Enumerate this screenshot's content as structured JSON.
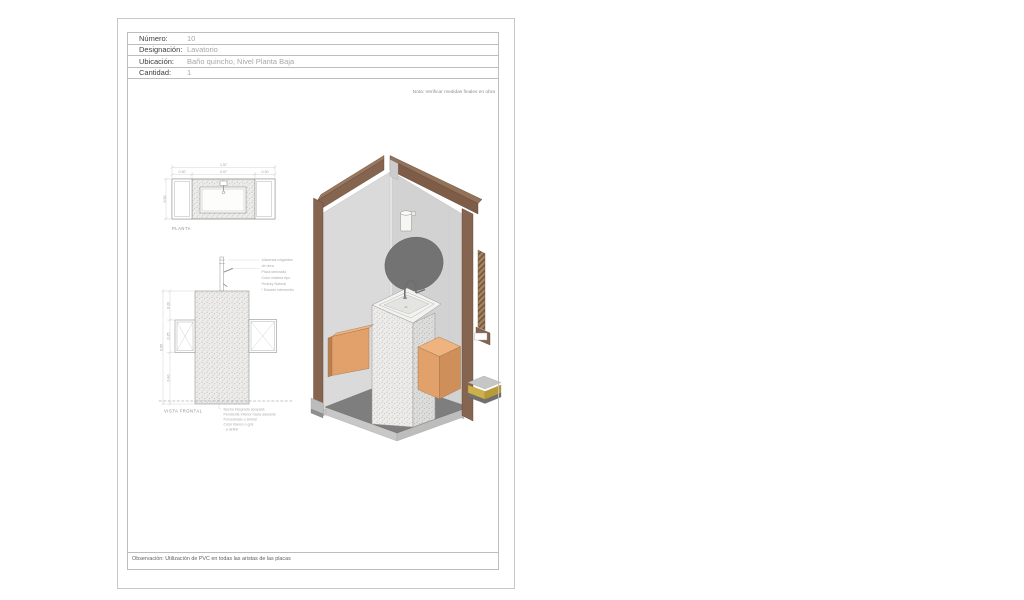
{
  "header_table": {
    "rows": [
      {
        "label": "Número:",
        "value": "10"
      },
      {
        "label": "Designación:",
        "value": "Lavatorio"
      },
      {
        "label": "Ubicación:",
        "value": "Baño quincho, Nivel Planta Baja"
      },
      {
        "label": "Cantidad:",
        "value": "1"
      }
    ],
    "note": "Nota: Verificar medidas finales en obra"
  },
  "plan_view": {
    "caption": "PLANTA",
    "dim_total": "1.57",
    "dim_left": "0.30",
    "dim_center": "0.97",
    "dim_right": "0.30",
    "dim_depth": "0.50"
  },
  "front_view": {
    "caption": "VISTA FRONTAL",
    "dim_total": "0.85",
    "dim_top": "0.20",
    "dim_mid": "0.25",
    "dim_bottom": "0.40",
    "right_note_lines": [
      "Alacenas colgantes",
      "de obra",
      "Placa laminada",
      "Color madera tipo",
      "Hickory Natural",
      "* Estante intermedio"
    ],
    "bottom_note_lines": [
      "Bacha integrada apoyada",
      "Pendiente inferior hacia adelante",
      "Porcelanato o similar",
      "Color blanco o gris",
      "- a definir"
    ]
  },
  "footer": {
    "observation": "Observación: Utilización de PVC en todas las aristas de las placas"
  },
  "colors": {
    "wood_frame": "#85654f",
    "wood_frame_light": "#9a7860",
    "cabinet_orange": "#e2a06b",
    "cabinet_orange_top": "#efb380",
    "cabinet_orange_dark": "#cf8f5b",
    "wall_gray_left": "#dadada",
    "wall_gray_right": "#d2d2d2",
    "floor_dark": "#7e7e7e",
    "floor_skirt": "#c4c4c4",
    "mirror_gray": "#737373",
    "terrazzo_base": "#edecea",
    "accent_yellow": "#cdb049"
  }
}
